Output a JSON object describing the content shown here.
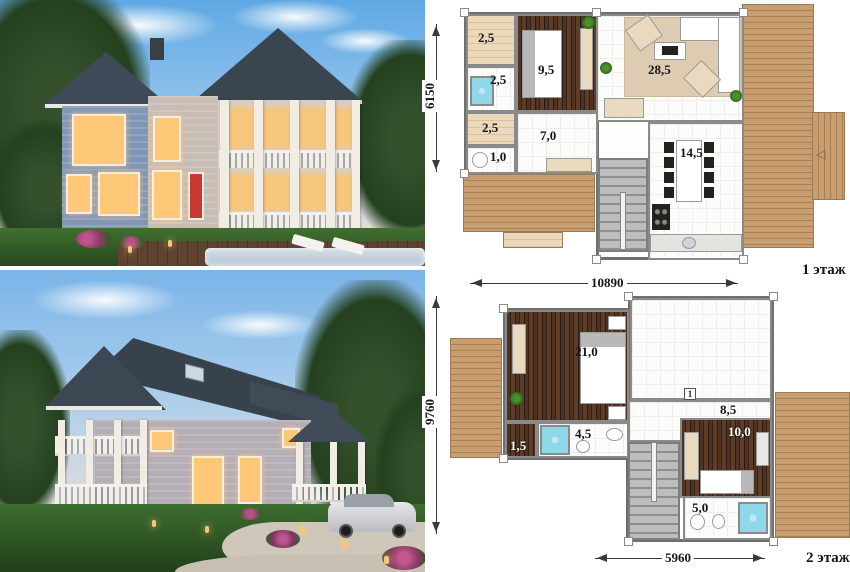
{
  "collage": {
    "photo_front_name": "house-3d-render-front-pool-evening",
    "photo_rear_name": "house-3d-render-rear-driveway-evening"
  },
  "floor1": {
    "caption": "1 этаж",
    "dim_height": "6150",
    "dim_width": "10890",
    "rooms": {
      "sauna": "2,5",
      "bath": "2,5",
      "closet": "2,5",
      "wc": "1,0",
      "bedroom": "9,5",
      "hall": "7,0",
      "living": "28,5",
      "kitchen": "14,5"
    }
  },
  "floor2": {
    "caption": "2 этаж",
    "dim_height": "9760",
    "dim_width": "5960",
    "marker": "1",
    "rooms": {
      "bedroom": "21,0",
      "closet": "1,5",
      "bath": "4,5",
      "hall": "8,5",
      "bedroom2": "10,0",
      "bath2": "5,0"
    }
  },
  "palette": {
    "deck_wood": "#c89d6f",
    "deck_wood_line": "#a87e52",
    "dark_floor": "#46291c",
    "jacuzzi_blue": "#8fd8ea",
    "stair_grey": "#a9a9a9",
    "rug_beige": "#ddccb1",
    "wall_outline": "#6f6f6f",
    "sky_blue": "#7fbce9",
    "lawn_green": "#3d6a30",
    "roof_dark": "#3c4854",
    "window_warm": "#ffc879",
    "accent_red": "#c9392f"
  }
}
